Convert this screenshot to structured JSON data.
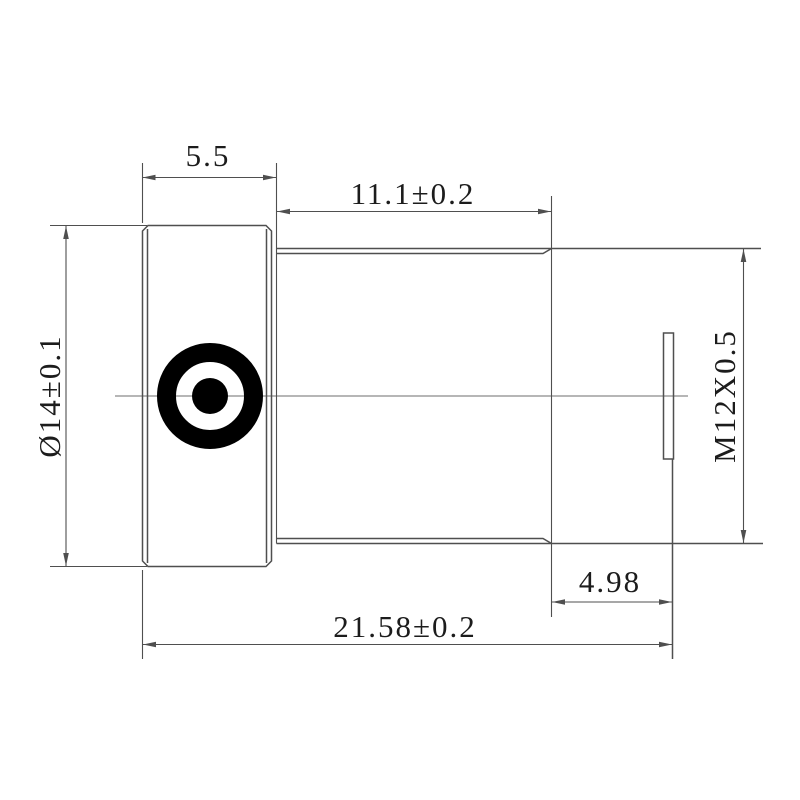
{
  "drawing": {
    "type": "mechanical-part-drawing",
    "part": "M12 lens barrel side view",
    "dimensions": {
      "flange_width": "5.5",
      "barrel_length": "11.1±0.2",
      "flange_diameter": "Ø14±0.1",
      "thread_spec": "M12X0.5",
      "rear_length": "4.98",
      "total_length": "21.58±0.2"
    },
    "colors": {
      "outline": "#4f4f4f",
      "dimension": "#4f4f4f",
      "centerline": "#6e6e6e",
      "text": "#1c1c1c",
      "lens_mark": "#000000",
      "background": "#ffffff"
    }
  }
}
